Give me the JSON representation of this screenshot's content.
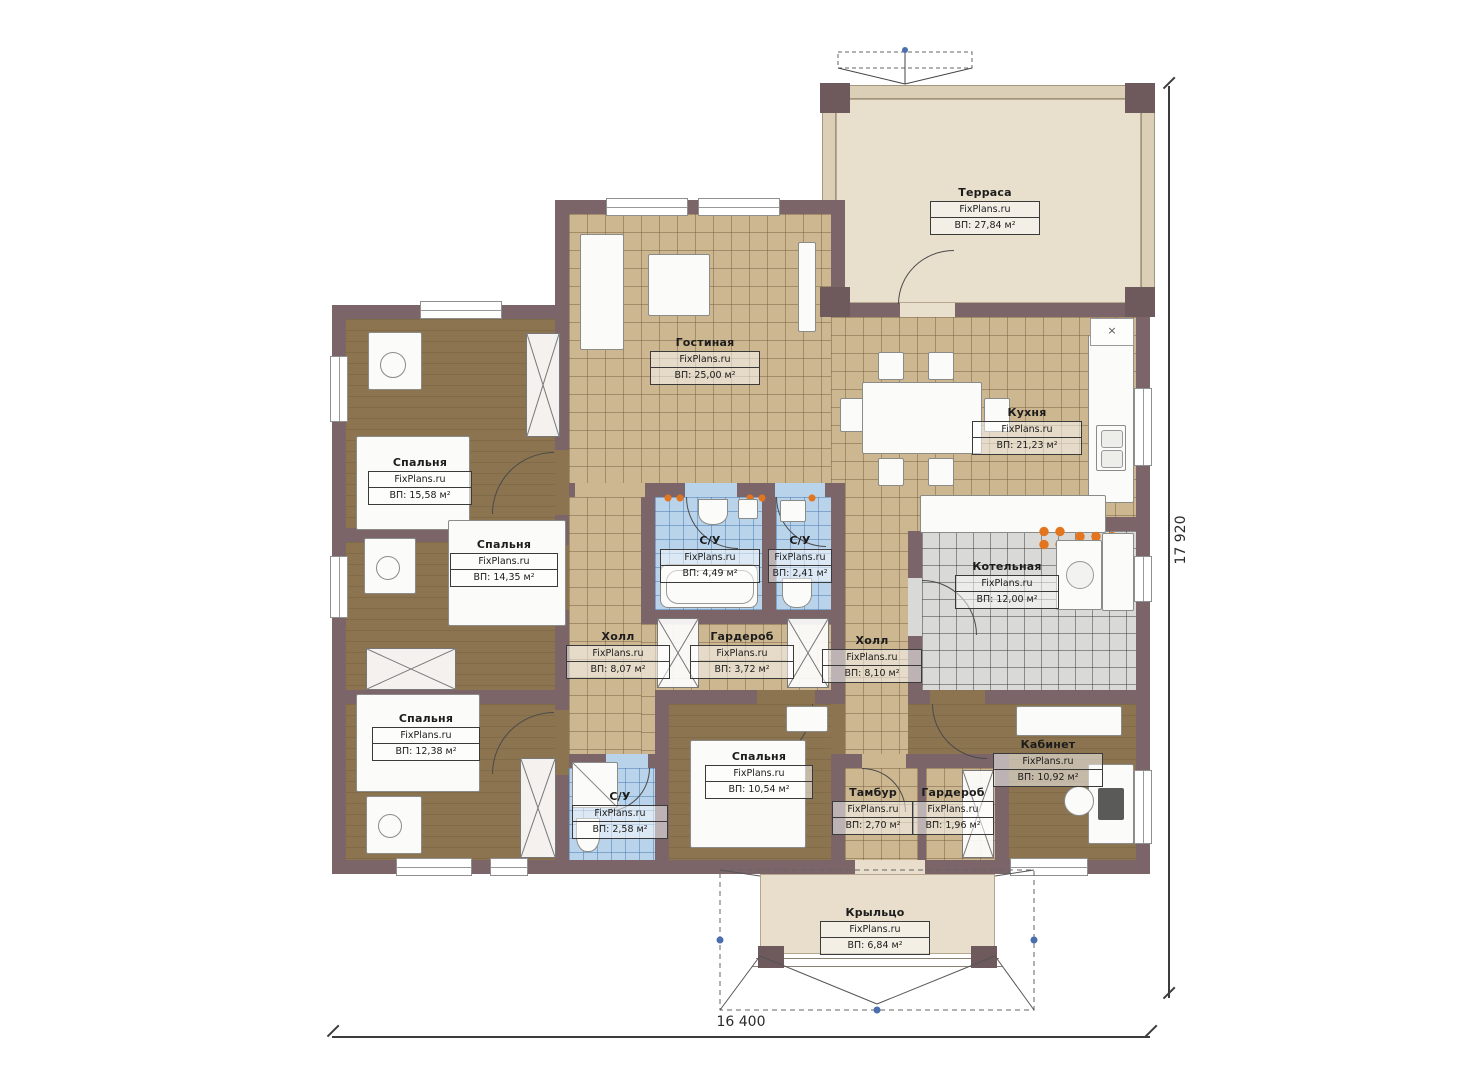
{
  "plan": {
    "brand": "FixPlans.ru",
    "dimensions": {
      "width": "16 400",
      "height": "17 920"
    },
    "palette": {
      "wall": "#7b6569",
      "tile_floor": "#cdb791",
      "wood_floor": "#8b744f",
      "bath_floor": "#b9d3ea",
      "boiler_floor": "#d9d9d7",
      "terrace_floor": "#e9dfcd",
      "accent_orange": "#e2751d"
    },
    "rooms": {
      "terrace": {
        "name": "Терраса",
        "area": "ВП: 27,84 м²"
      },
      "living": {
        "name": "Гостиная",
        "area": "ВП: 25,00 м²"
      },
      "kitchen": {
        "name": "Кухня",
        "area": "ВП: 21,23 м²"
      },
      "bedroom1": {
        "name": "Спальня",
        "area": "ВП: 15,58 м²"
      },
      "bedroom2": {
        "name": "Спальня",
        "area": "ВП: 14,35 м²"
      },
      "bedroom3": {
        "name": "Спальня",
        "area": "ВП: 12,38 м²"
      },
      "bedroom4": {
        "name": "Спальня",
        "area": "ВП: 10,54 м²"
      },
      "bath1": {
        "name": "С/У",
        "area": "ВП: 4,49 м²"
      },
      "bath2": {
        "name": "С/У",
        "area": "ВП: 2,41 м²"
      },
      "bath3": {
        "name": "С/У",
        "area": "ВП: 2,58 м²"
      },
      "hall1": {
        "name": "Холл",
        "area": "ВП: 8,07 м²"
      },
      "hall2": {
        "name": "Холл",
        "area": "ВП: 8,10 м²"
      },
      "wardrobe1": {
        "name": "Гардероб",
        "area": "ВП: 3,72 м²"
      },
      "wardrobe2": {
        "name": "Гардероб",
        "area": "ВП: 1,96 м²"
      },
      "boiler": {
        "name": "Котельная",
        "area": "ВП: 12,00 м²"
      },
      "tambour": {
        "name": "Тамбур",
        "area": "ВП: 2,70 м²"
      },
      "office": {
        "name": "Кабинет",
        "area": "ВП: 10,92 м²"
      },
      "porch": {
        "name": "Крыльцо",
        "area": "ВП: 6,84 м²"
      }
    }
  }
}
